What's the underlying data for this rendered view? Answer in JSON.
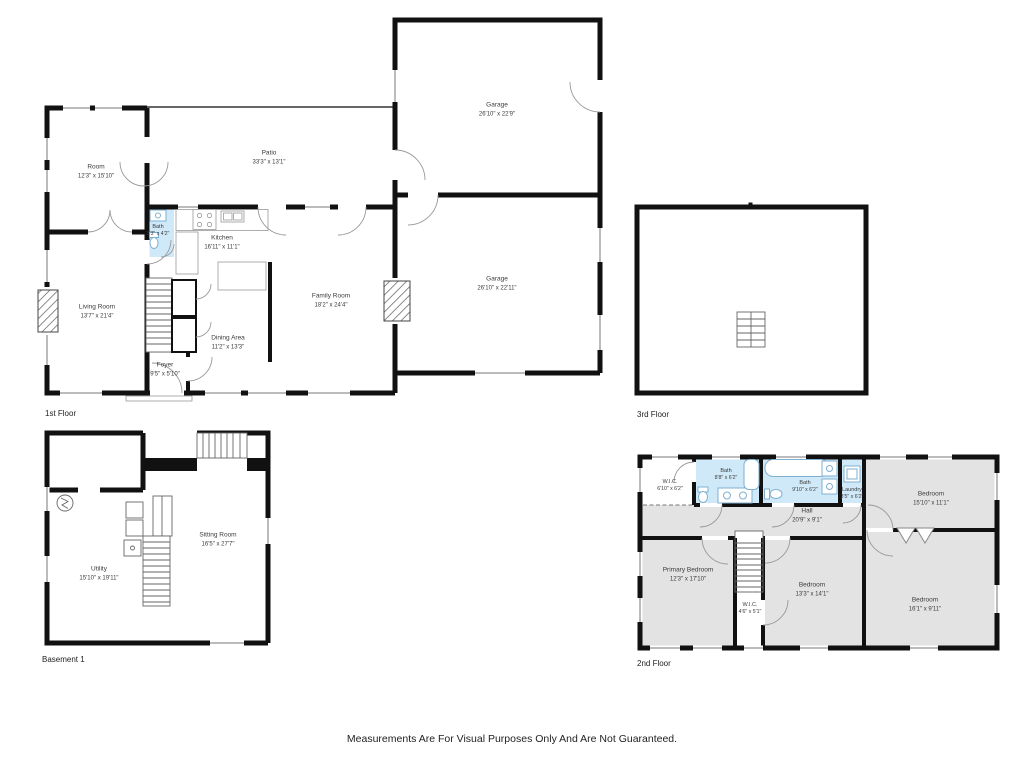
{
  "colors": {
    "wall": "#111111",
    "bath_fill": "#cfe9f9",
    "bedroom_fill": "#e3e3e3",
    "text": "#3b3b3b"
  },
  "icons": [
    "stairs-icon",
    "toilet-icon",
    "vanity-sink-icon",
    "bathtub-icon",
    "stove-icon",
    "kitchen-sink-icon",
    "water-heater-icon",
    "fireplace-icon",
    "washer-icon",
    "dryer-icon",
    "utility-sink-icon",
    "door-arc",
    "window"
  ],
  "floors": {
    "first": {
      "label": "1st Floor",
      "rooms": {
        "room": {
          "name": "Room",
          "dims": "12'3\" x 15'10\""
        },
        "patio": {
          "name": "Patio",
          "dims": "33'3\" x 13'1\""
        },
        "garage_upper": {
          "name": "Garage",
          "dims": "26'10\" x 22'9\""
        },
        "garage_lower": {
          "name": "Garage",
          "dims": "26'10\" x 22'11\""
        },
        "bath": {
          "name": "Bath",
          "dims": "3'3\" x 4'2\""
        },
        "kitchen": {
          "name": "Kitchen",
          "dims": "16'11\" x 11'1\""
        },
        "living_room": {
          "name": "Living Room",
          "dims": "13'7\" x 21'4\""
        },
        "family_room": {
          "name": "Family Room",
          "dims": "18'2\" x 24'4\""
        },
        "dining_area": {
          "name": "Dining Area",
          "dims": "11'2\" x 13'3\""
        },
        "foyer": {
          "name": "Foyer",
          "dims": "9'5\" x 5'10\""
        }
      }
    },
    "third": {
      "label": "3rd Floor",
      "rooms": {}
    },
    "basement": {
      "label": "Basement 1",
      "rooms": {
        "utility": {
          "name": "Utility",
          "dims": "15'10\" x 19'11\""
        },
        "sitting_room": {
          "name": "Sitting Room",
          "dims": "16'5\" x 27'7\""
        }
      }
    },
    "second": {
      "label": "2nd Floor",
      "rooms": {
        "wic_top": {
          "name": "W.I.C.",
          "dims": "6'10\" x 6'2\""
        },
        "bath_left": {
          "name": "Bath",
          "dims": "8'8\" x 6'2\""
        },
        "bath_right": {
          "name": "Bath",
          "dims": "9'10\" x 6'2\""
        },
        "laundry": {
          "name": "Laundry",
          "dims": "3'5\" x 6'2\""
        },
        "bedroom_top_right": {
          "name": "Bedroom",
          "dims": "15'10\" x 11'1\""
        },
        "hall": {
          "name": "Hall",
          "dims": "20'9\" x 9'1\""
        },
        "primary_bedroom": {
          "name": "Primary Bedroom",
          "dims": "12'3\" x 17'10\""
        },
        "bedroom_middle": {
          "name": "Bedroom",
          "dims": "13'3\" x 14'1\""
        },
        "wic_bottom": {
          "name": "W.I.C.",
          "dims": "4'6\" x 5'1\""
        },
        "bedroom_bottom_right": {
          "name": "Bedroom",
          "dims": "16'1\" x 9'11\""
        }
      }
    }
  },
  "footer": {
    "disclaimer": "Measurements Are For Visual Purposes Only And Are Not Guaranteed."
  }
}
